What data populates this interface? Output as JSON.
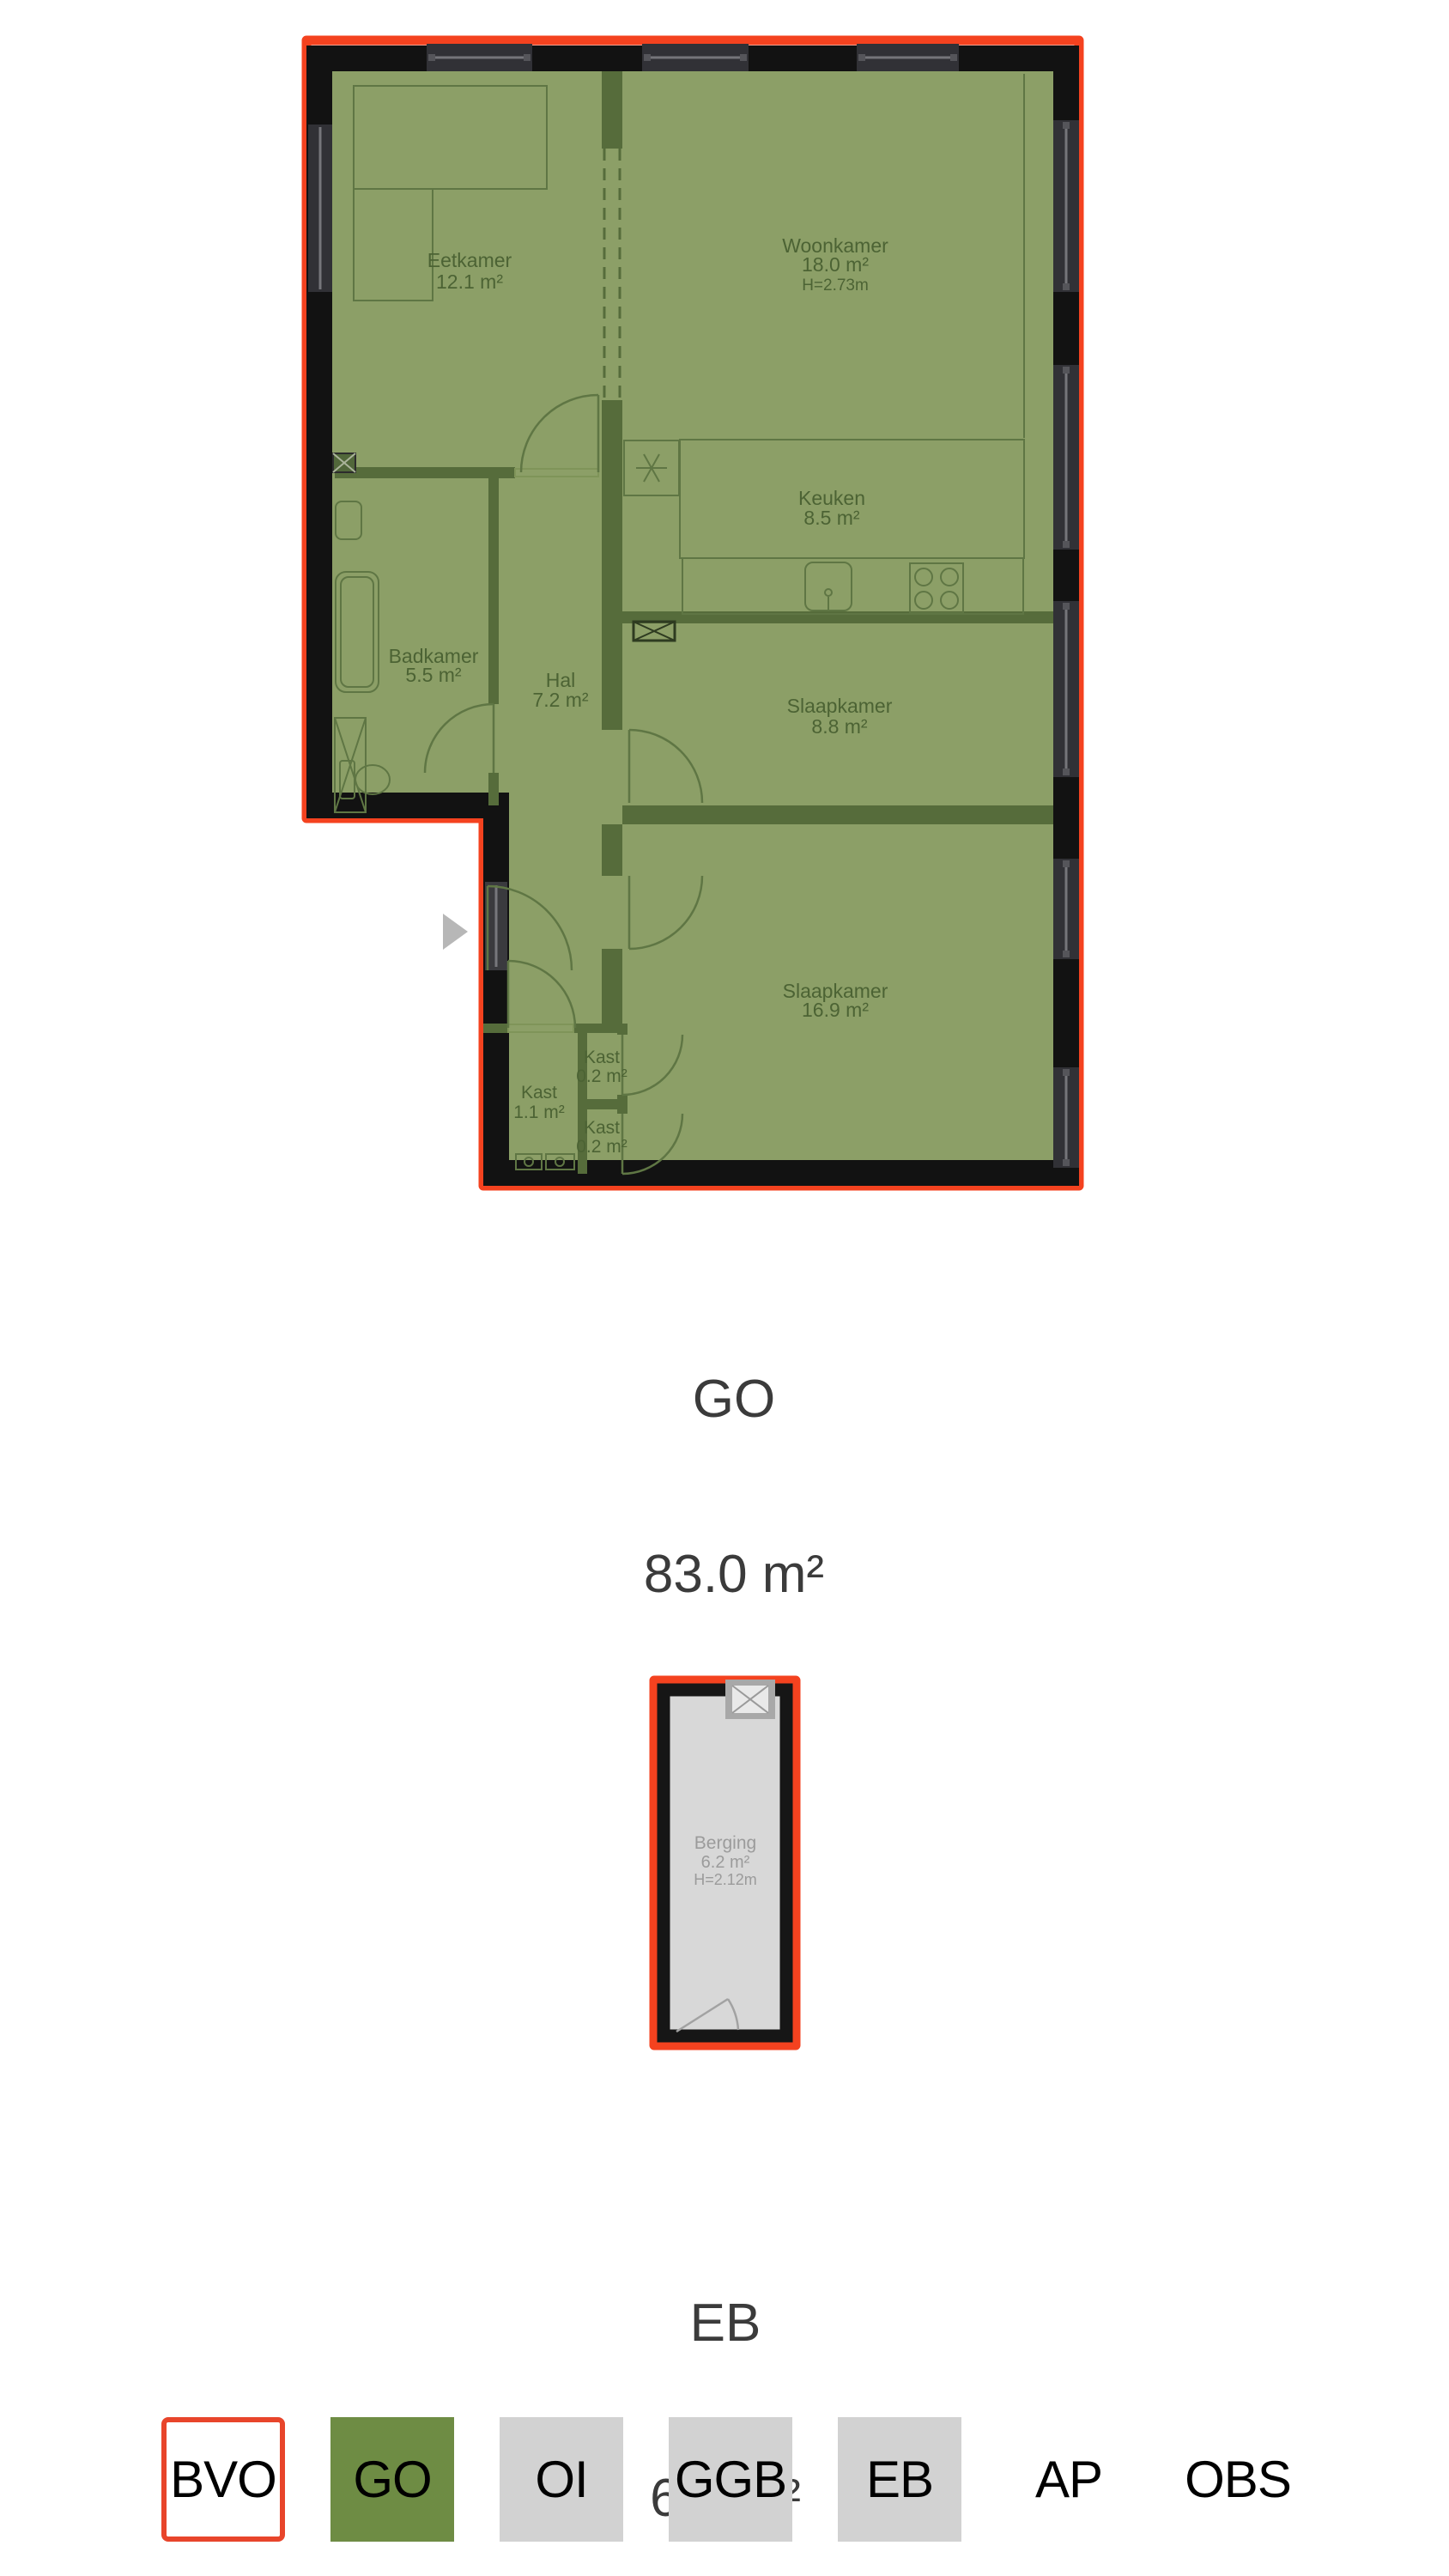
{
  "floorplans": [
    {
      "code": "GO",
      "caption_label": "GO",
      "caption_area": "83.0 m²",
      "overlay_color": "#8c9f67",
      "outline_color": "#f4421f",
      "rooms": [
        {
          "name": "Eetkamer",
          "area": "12.1 m²"
        },
        {
          "name": "Woonkamer",
          "area": "18.0 m²",
          "height": "H=2.73m"
        },
        {
          "name": "Keuken",
          "area": "8.5 m²"
        },
        {
          "name": "Badkamer",
          "area": "5.5 m²"
        },
        {
          "name": "Hal",
          "area": "7.2 m²"
        },
        {
          "name": "Slaapkamer",
          "area": "8.8 m²"
        },
        {
          "name": "Slaapkamer",
          "area": "16.9 m²"
        },
        {
          "name": "Kast",
          "area": "1.1 m²"
        },
        {
          "name": "Kast",
          "area": "0.2 m²"
        },
        {
          "name": "Kast",
          "area": "0.2 m²"
        }
      ]
    },
    {
      "code": "EB",
      "caption_label": "EB",
      "caption_area": "6.4 m²",
      "overlay_color": "#d8d8d8",
      "outline_color": "#f4421f",
      "rooms": [
        {
          "name": "Berging",
          "area": "6.2 m²",
          "height": "H=2.12m"
        }
      ]
    }
  ],
  "legend": {
    "items": [
      {
        "label": "BVO",
        "style": "outlined"
      },
      {
        "label": "GO",
        "style": "green"
      },
      {
        "label": "OI",
        "style": "gray"
      },
      {
        "label": "GGB",
        "style": "gray"
      },
      {
        "label": "EB",
        "style": "gray"
      },
      {
        "label": "AP",
        "style": "plain"
      },
      {
        "label": "OBS",
        "style": "plain"
      }
    ],
    "colors": {
      "selected_outline_red": "#e8452b",
      "go_green": "#6e8c44",
      "neutral_gray": "#d2d2d2"
    }
  }
}
